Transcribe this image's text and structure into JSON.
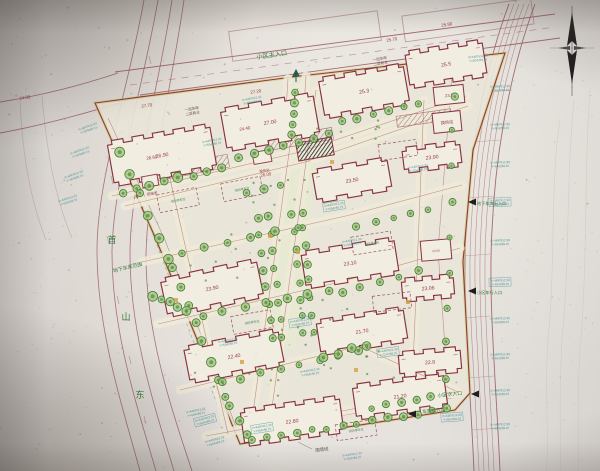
{
  "scene": {
    "width": 600,
    "height": 471,
    "kind": "photo of residential district master site plan drawing"
  },
  "palette": {
    "paper": "#e6e2dd",
    "site_fill": "#ece7d8",
    "street_fill": "#f2ecd8",
    "axis_fill": "#e9eccf",
    "building_fill": "#f4efe2",
    "building_line": "#8d2f3e",
    "road_line": "#9c5560",
    "faint_line": "#c9c2ba",
    "boundary_yellow": "#d8c95f",
    "tree_ring": "#3e7d2f",
    "tree_fill": "#9ec978",
    "shrub": "#4e7d35",
    "label_green": "#2f7d3a",
    "annotation_teal": "#2e8f96",
    "elevation_red": "#a03a4a",
    "dark": "#1c1c1c",
    "accent_orange": "#d9a13a",
    "text_dark": "#5a5350",
    "podium_text": "#704c55"
  },
  "labels": {
    "main_entrance": "小区主入口",
    "secondary_entrance": "小区次入口",
    "garage_exit": "车库出入口",
    "underground_garage_entrance": "地下车库出入口",
    "vehicle_entrance": "小区车行入口",
    "garage_extent": "地下车库范围",
    "wall_line": "围墙线",
    "fire_parking": "消防停车位",
    "power_room": "配电室",
    "heat_station": "换热站",
    "podium_line1": "一层车库",
    "podium_line2": "二层商业",
    "road_chars": [
      [
        "首",
        112,
        243
      ],
      [
        "山",
        126,
        320
      ],
      [
        "东",
        140,
        398
      ]
    ]
  },
  "annotation_text": {
    "line1": "X=4487612.33",
    "line2": "Y=504268.15"
  },
  "site": {
    "outline": [
      [
        95,
        103
      ],
      [
        300,
        76
      ],
      [
        505,
        53
      ],
      [
        473,
        150
      ],
      [
        463,
        262
      ],
      [
        470,
        393
      ],
      [
        455,
        410
      ],
      [
        240,
        444
      ],
      [
        155,
        237
      ]
    ],
    "inner_lines": [
      [
        [
          108,
          118
        ],
        [
          165,
          240
        ],
        [
          238,
          432
        ]
      ],
      [
        [
          238,
          432
        ],
        [
          452,
          398
        ]
      ],
      [
        [
          452,
          75
        ],
        [
          438,
          250
        ],
        [
          448,
          388
        ]
      ]
    ],
    "axis_polygon": [
      [
        285,
        140
      ],
      [
        320,
        140
      ],
      [
        295,
        350
      ],
      [
        258,
        350
      ]
    ],
    "garage_dash_line": [
      [
        140,
        200
      ],
      [
        225,
        425
      ]
    ]
  },
  "roads": {
    "top": [
      "M115,72 L555,14",
      "M140,95 L560,38",
      "M0,102 C45,95 85,84 118,73",
      "M0,133 C50,124 100,109 143,96"
    ],
    "top_dash": "M130,85 L555,27",
    "left": [
      "M144,0 C128,90 97,180 97,250 C97,330 122,405 140,471",
      "M158,0 C142,92 113,182 112,252 C112,332 137,406 156,471",
      "M172,0 C158,94 130,184 130,254 C130,334 155,408 174,471",
      "M184,0 C170,96 147,186 146,256 C146,336 172,410 192,471"
    ],
    "left_dashes": [
      [
        150,
        60
      ],
      [
        128,
        120
      ],
      [
        112,
        180
      ],
      [
        108,
        240
      ],
      [
        118,
        300
      ],
      [
        130,
        360
      ],
      [
        145,
        420
      ]
    ],
    "right_offsets": [
      0,
      5,
      10,
      15,
      20,
      26
    ],
    "right_template": [
      509,
      488,
      470,
      466,
      462,
      470,
      474
    ],
    "right_ticks": [
      [
        486,
        92
      ],
      [
        474,
        142
      ],
      [
        468,
        198
      ],
      [
        464,
        256
      ],
      [
        464,
        318
      ],
      [
        468,
        378
      ],
      [
        472,
        430
      ]
    ],
    "sw_faint": [
      "M20,100 C22,150 30,200 46,240",
      "M42,96 C46,146 54,196 72,238"
    ],
    "contours": [
      "M560,120 C550,180 556,260 548,340 C544,400 550,440 546,471",
      "M574,100 C566,180 570,260 562,340 C558,410 562,445 560,471",
      "M590,90 C584,170 588,260 580,350 C576,415 580,448 578,471"
    ]
  },
  "existing_buildings": [
    [
      305,
      36,
      150,
      30,
      -8
    ],
    [
      468,
      20,
      130,
      26,
      -8
    ]
  ],
  "internal_lines": [
    [
      [
        112,
        196
      ],
      [
        300,
        152
      ],
      [
        466,
        96
      ]
    ],
    [
      [
        125,
        206
      ],
      [
        305,
        162
      ],
      [
        468,
        106
      ]
    ],
    [
      [
        142,
        262
      ],
      [
        350,
        215
      ],
      [
        462,
        185
      ]
    ],
    [
      [
        158,
        324
      ],
      [
        340,
        282
      ],
      [
        460,
        248
      ]
    ],
    [
      [
        180,
        390
      ],
      [
        360,
        346
      ],
      [
        458,
        392
      ]
    ],
    [
      [
        206,
        436
      ],
      [
        380,
        404
      ],
      [
        458,
        392
      ]
    ],
    [
      [
        298,
        88
      ],
      [
        252,
        420
      ]
    ],
    [
      [
        316,
        90
      ],
      [
        270,
        422
      ]
    ],
    [
      [
        424,
        100
      ],
      [
        412,
        390
      ]
    ],
    [
      [
        168,
        170
      ],
      [
        228,
        434
      ]
    ],
    [
      [
        288,
        79
      ],
      [
        284,
        140
      ]
    ],
    [
      [
        306,
        76
      ],
      [
        302,
        138
      ]
    ]
  ],
  "buildings": [
    {
      "cx": 162,
      "cy": 155,
      "w": 104,
      "h": 46,
      "rot": -10,
      "label": "26.90"
    },
    {
      "cx": 270,
      "cy": 122,
      "w": 94,
      "h": 44,
      "rot": -10,
      "label": "27.00"
    },
    {
      "cx": 364,
      "cy": 91,
      "w": 86,
      "h": 42,
      "rot": -10,
      "label": "25.3"
    },
    {
      "cx": 446,
      "cy": 64,
      "w": 78,
      "h": 38,
      "rot": -9,
      "label": "25.5"
    },
    {
      "cx": 352,
      "cy": 180,
      "w": 76,
      "h": 34,
      "rot": -10,
      "label": "23.50"
    },
    {
      "cx": 212,
      "cy": 288,
      "w": 98,
      "h": 40,
      "rot": -12,
      "label": "23.90"
    },
    {
      "cx": 350,
      "cy": 263,
      "w": 94,
      "h": 38,
      "rot": -9,
      "label": "23.10"
    },
    {
      "cx": 234,
      "cy": 356,
      "w": 96,
      "h": 38,
      "rot": -11,
      "label": "22.40"
    },
    {
      "cx": 362,
      "cy": 331,
      "w": 88,
      "h": 36,
      "rot": -9,
      "label": "21.70"
    },
    {
      "cx": 292,
      "cy": 421,
      "w": 100,
      "h": 38,
      "rot": -8,
      "label": "22.80"
    },
    {
      "cx": 400,
      "cy": 396,
      "w": 92,
      "h": 36,
      "rot": -8,
      "label": "21.20"
    },
    {
      "cx": 432,
      "cy": 157,
      "w": 58,
      "h": 26,
      "rot": -7,
      "label": "23.90"
    },
    {
      "cx": 428,
      "cy": 288,
      "w": 52,
      "h": 24,
      "rot": -5,
      "label": "23.06"
    },
    {
      "cx": 430,
      "cy": 362,
      "w": 62,
      "h": 26,
      "rot": -5,
      "label": "22.8"
    }
  ],
  "service_boxes": [
    {
      "cx": 449,
      "cy": 95,
      "w": 30,
      "h": 18,
      "rot": -6,
      "label": "23.5"
    },
    {
      "cx": 447,
      "cy": 122,
      "w": 28,
      "h": 20,
      "rot": -6,
      "label": "换热站"
    },
    {
      "cx": 436,
      "cy": 250,
      "w": 30,
      "h": 20,
      "rot": -5,
      "label": "24.50"
    }
  ],
  "utility_boxes": [
    {
      "cx": 150,
      "cy": 181,
      "w": 16,
      "h": 11,
      "rot": -10,
      "label": "配电室",
      "ly": 14
    },
    {
      "cx": 262,
      "cy": 157,
      "w": 18,
      "h": 12,
      "rot": -10,
      "label": "换热站",
      "ly": 15
    }
  ],
  "gatehouse": {
    "cx": 315,
    "cy": 149,
    "w": 36,
    "h": 18,
    "rot": -10
  },
  "fire_boxes": [
    {
      "cx": 178,
      "cy": 200,
      "w": 40,
      "h": 18,
      "rot": -11,
      "labeled": true
    },
    {
      "cx": 242,
      "cy": 189,
      "w": 40,
      "h": 18,
      "rot": -11,
      "labeled": true
    },
    {
      "cx": 398,
      "cy": 150,
      "w": 38,
      "h": 16,
      "rot": -8,
      "labeled": false
    },
    {
      "cx": 372,
      "cy": 243,
      "w": 40,
      "h": 18,
      "rot": -9,
      "labeled": true
    },
    {
      "cx": 252,
      "cy": 322,
      "w": 40,
      "h": 18,
      "rot": -10,
      "labeled": true
    },
    {
      "cx": 392,
      "cy": 302,
      "w": 38,
      "h": 16,
      "rot": -7,
      "labeled": false
    },
    {
      "cx": 356,
      "cy": 430,
      "w": 40,
      "h": 16,
      "rot": -8,
      "labeled": true
    }
  ],
  "hatch_strips": [
    [
      190,
      168,
      78,
      13,
      -11
    ],
    [
      300,
      139,
      66,
      12,
      -10
    ],
    [
      424,
      118,
      55,
      11,
      -8
    ]
  ],
  "tree_rows": [
    [
      296,
      92,
      293,
      134,
      5,
      3.4
    ],
    [
      122,
      192,
      222,
      168,
      8,
      4
    ],
    [
      238,
      158,
      330,
      134,
      7,
      4
    ],
    [
      342,
      122,
      418,
      103,
      6,
      3.4
    ],
    [
      120,
      152,
      168,
      258,
      6,
      4
    ],
    [
      172,
      268,
      226,
      398,
      8,
      4
    ],
    [
      230,
      406,
      248,
      434,
      3,
      3.6
    ],
    [
      252,
      440,
      448,
      409,
      14,
      3.4
    ],
    [
      258,
      218,
      272,
      338,
      8,
      3.2
    ],
    [
      268,
      216,
      282,
      336,
      8,
      3.2
    ],
    [
      292,
      214,
      304,
      334,
      8,
      3.2
    ],
    [
      302,
      212,
      314,
      332,
      8,
      3.2
    ],
    [
      454,
      96,
      446,
      378,
      9,
      3
    ],
    [
      182,
      252,
      298,
      227,
      6,
      3.6
    ],
    [
      202,
      316,
      330,
      291,
      7,
      3.6
    ],
    [
      222,
      382,
      358,
      352,
      8,
      3.4
    ],
    [
      342,
      292,
      418,
      272,
      5,
      3.4
    ],
    [
      357,
      227,
      428,
      209,
      5,
      3.2
    ],
    [
      152,
      296,
      186,
      310,
      5,
      4
    ],
    [
      322,
      356,
      368,
      346,
      4,
      3.6
    ],
    [
      246,
      192,
      280,
      186,
      3,
      3.4
    ],
    [
      372,
      408,
      432,
      396,
      5,
      3.2
    ]
  ],
  "shrub_areas": [
    [
      160,
      230,
      120,
      60
    ],
    [
      230,
      300,
      120,
      50
    ],
    [
      250,
      180,
      60,
      30
    ],
    [
      320,
      340,
      80,
      40
    ],
    [
      180,
      360,
      100,
      40
    ],
    [
      300,
      120,
      80,
      30
    ]
  ],
  "accent_dots": [
    [
      176,
      300
    ],
    [
      298,
      252
    ],
    [
      242,
      362
    ],
    [
      408,
      302
    ],
    [
      332,
      162
    ],
    [
      270,
      236
    ],
    [
      356,
      370
    ]
  ],
  "annotations": [
    [
      88,
      128,
      -20,
      false
    ],
    [
      80,
      152,
      -20,
      false
    ],
    [
      74,
      176,
      -20,
      false
    ],
    [
      68,
      200,
      -18,
      false
    ],
    [
      205,
      420,
      -15,
      true
    ],
    [
      215,
      441,
      -15,
      false
    ],
    [
      212,
      142,
      -10,
      false
    ],
    [
      252,
      100,
      -10,
      false
    ],
    [
      334,
      206,
      -9,
      true
    ],
    [
      418,
      168,
      -8,
      false
    ],
    [
      352,
      242,
      -9,
      false
    ],
    [
      300,
      322,
      -9,
      true
    ],
    [
      228,
      342,
      -10,
      false
    ],
    [
      388,
      352,
      -8,
      true
    ],
    [
      310,
      372,
      -9,
      false
    ],
    [
      262,
      428,
      -9,
      true
    ],
    [
      196,
      412,
      -12,
      false
    ],
    [
      500,
      88,
      -2,
      false
    ],
    [
      500,
      126,
      -2,
      false
    ],
    [
      500,
      164,
      -2,
      false
    ],
    [
      500,
      202,
      -2,
      true
    ],
    [
      500,
      242,
      -2,
      false
    ],
    [
      500,
      282,
      -2,
      true
    ],
    [
      500,
      320,
      -2,
      false
    ],
    [
      500,
      356,
      -2,
      false
    ],
    [
      500,
      392,
      -2,
      false
    ],
    [
      500,
      426,
      -2,
      false
    ],
    [
      478,
      58,
      -6,
      false
    ],
    [
      452,
      417,
      -4,
      true
    ],
    [
      352,
      456,
      -8,
      false
    ]
  ],
  "elevations": [
    [
      256,
      93,
      "27.20"
    ],
    [
      147,
      107,
      "27.70"
    ],
    [
      447,
      26,
      "25.90"
    ],
    [
      392,
      41,
      "25.70"
    ],
    [
      152,
      159,
      "26.60"
    ],
    [
      245,
      130,
      "24.40"
    ],
    [
      266,
      176,
      "26.00"
    ],
    [
      25,
      99,
      "24.90"
    ]
  ],
  "green_labels": [
    {
      "key": "main_entrance",
      "x": 272,
      "y": 57,
      "s": 6.2,
      "rot": -8,
      "anchor": "middle"
    },
    {
      "key": "secondary_entrance",
      "x": 450,
      "y": 396,
      "s": 5,
      "rot": -7,
      "anchor": "middle"
    },
    {
      "key": "garage_exit",
      "x": 434,
      "y": 412,
      "s": 4.6,
      "rot": -7,
      "anchor": "middle"
    },
    {
      "key": "underground_garage_entrance",
      "x": 477,
      "y": 205,
      "s": 4.2,
      "rot": 0,
      "anchor": "start"
    },
    {
      "key": "vehicle_entrance",
      "x": 477,
      "y": 294,
      "s": 4.2,
      "rot": 0,
      "anchor": "start"
    },
    {
      "key": "garage_extent",
      "x": 128,
      "y": 269,
      "s": 5,
      "rot": -14,
      "anchor": "middle"
    }
  ],
  "podium_notes": [
    {
      "x": 192,
      "y": 110,
      "rot": -10
    },
    {
      "x": 380,
      "y": 60,
      "rot": -10
    }
  ],
  "wall_label": {
    "x": 322,
    "y": 451,
    "s": 4.4,
    "rot": -6,
    "leader": [
      [
        312,
        449
      ],
      [
        298,
        442
      ]
    ]
  },
  "arrows": [
    [
      468,
      202
    ],
    [
      468,
      291
    ],
    [
      471,
      394
    ],
    [
      408,
      414
    ]
  ],
  "compass": {
    "x": 572,
    "top": 6,
    "bottom": 96,
    "cross_y": 48
  }
}
